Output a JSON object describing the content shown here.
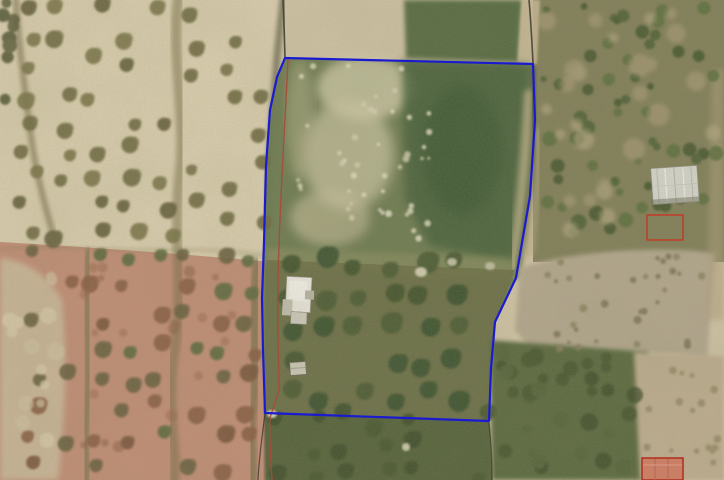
{
  "meta": {
    "kind": "aerial-orthophoto-with-cadastral-overlay",
    "width": 724,
    "height": 480
  },
  "overlay_colors": {
    "parcel_blue": "#1a1ad0",
    "cadastral_red": "#a84a38",
    "marker_red": "#c23b28",
    "roof_red": "#b23322"
  },
  "scene": {
    "layers": [
      {
        "type": "rect",
        "name": "base-ground",
        "x": 0,
        "y": 0,
        "w": 724,
        "h": 480,
        "fill": "#d2c4a6"
      },
      {
        "type": "path",
        "name": "field-left-top",
        "d": "M0,0 H283 V263 Q140,250 0,242 Z",
        "fill": "#dbcfaf"
      },
      {
        "type": "path",
        "name": "field-left-bottom",
        "d": "M0,242 Q140,250 283,263 V480 H0 Z",
        "fill": "#c28e76"
      },
      {
        "type": "path",
        "name": "field-left-far-pale",
        "d": "M0,258 Q40,262 62,300 Q70,380 58,480 H0 Z",
        "fill": "#cdbd9e",
        "opacity": 0.85,
        "blur": 3
      },
      {
        "type": "path",
        "name": "field-boundary-mid-horizontal",
        "d": "M0,248 C60,244 120,252 180,250 C230,249 262,255 283,259",
        "stroke": "#8a7a55",
        "width": 3,
        "opacity": 0.35,
        "blur": 2
      },
      {
        "type": "path",
        "name": "track-top-far-left",
        "d": "M16,0 C18,40 24,80 30,130 C34,160 40,190 52,230",
        "stroke": "#6a603b",
        "width": 6,
        "opacity": 0.55,
        "blur": 2
      },
      {
        "type": "path",
        "name": "track-mid-left-field",
        "d": "M178,0 C171,60 187,120 179,180 C173,240 185,300 173,360 C167,420 178,450 174,480",
        "stroke": "#756b42",
        "width": 10,
        "opacity": 0.5,
        "blur": 2
      },
      {
        "type": "path",
        "name": "track-left-lower",
        "d": "M89,252 C84,300 92,360 86,420 C84,450 87,465 86,480",
        "stroke": "#5e693c",
        "width": 8,
        "opacity": 0.5,
        "blur": 2
      },
      {
        "type": "path",
        "name": "track-right-lower",
        "d": "M257,262 C252,310 258,370 252,420 C250,450 254,465 252,480",
        "stroke": "#566139",
        "width": 9,
        "opacity": 0.5,
        "blur": 2
      },
      {
        "type": "rect",
        "name": "scrub-right-base",
        "x": 533,
        "y": 0,
        "w": 191,
        "h": 262,
        "fill": "#83805a"
      },
      {
        "type": "path",
        "name": "dark-green-patch-top",
        "d": "M404,0 L522,0 L518,62 L406,58 Z",
        "fill": "#4c6339",
        "opacity": 0.9,
        "blur": 2
      },
      {
        "type": "path",
        "name": "tan-strip-top-right",
        "d": "M522,0 L540,0 L537,64 L518,62 Z",
        "fill": "#c6b794",
        "opacity": 0.9,
        "blur": 1
      },
      {
        "type": "path",
        "name": "hedge-parcel-left",
        "d": "M283,0 C280,28 278,46 277,58 C272,120 267,200 266,260 C265,330 267,380 266,413 C266,440 267,460 267,480",
        "stroke": "#4e4c34",
        "width": 7,
        "opacity": 0.6,
        "blur": 2
      },
      {
        "type": "polygon",
        "name": "parcel-fill",
        "points": "285,58 533,64 535,120 530,196 516,278 495,322 491,368 489,421 265,413 263,350 262,298 264,242 266,166 270,110 277,77",
        "fill": "#6b7a4f",
        "opacity": 0.97
      },
      {
        "type": "ellipse",
        "name": "parcel-light-patch-a",
        "cx": 365,
        "cy": 88,
        "rx": 48,
        "ry": 32,
        "fill": "#d8d0ae",
        "opacity": 0.75,
        "blur": 5
      },
      {
        "type": "ellipse",
        "name": "parcel-light-patch-b",
        "cx": 348,
        "cy": 155,
        "rx": 46,
        "ry": 55,
        "fill": "#d3cba8",
        "opacity": 0.7,
        "blur": 6
      },
      {
        "type": "ellipse",
        "name": "parcel-light-patch-c",
        "cx": 330,
        "cy": 218,
        "rx": 40,
        "ry": 28,
        "fill": "#c9c09c",
        "opacity": 0.6,
        "blur": 5
      },
      {
        "type": "ellipse",
        "name": "parcel-light-patch-d",
        "cx": 300,
        "cy": 120,
        "rx": 14,
        "ry": 60,
        "fill": "#b8b48c",
        "opacity": 0.5,
        "blur": 5
      },
      {
        "type": "path",
        "name": "parcel-topright-dark-green",
        "d": "M402,60 L530,64 L524,190 L515,262 L430,246 L405,200 Z",
        "fill": "#46603a",
        "opacity": 0.8,
        "blur": 4
      },
      {
        "type": "ellipse",
        "name": "parcel-dark-blob",
        "cx": 462,
        "cy": 150,
        "rx": 40,
        "ry": 65,
        "fill": "#3b5430",
        "opacity": 0.55,
        "blur": 6
      },
      {
        "type": "path",
        "name": "parcel-right-tan-inside",
        "d": "M530,95 C527,150 522,205 514,265",
        "stroke": "#c8ba92",
        "width": 12,
        "opacity": 0.7,
        "blur": 3
      },
      {
        "type": "path",
        "name": "tan-streak-right-of-parcel",
        "d": "M538,135 C535,175 531,215 527,250",
        "stroke": "#b9aa84",
        "width": 16,
        "opacity": 0.5,
        "blur": 3
      },
      {
        "type": "path",
        "name": "parcel-mid-light-band",
        "d": "M266,248 L516,258 L513,278 L265,264 Z",
        "fill": "#9a9868",
        "opacity": 0.45,
        "blur": 3
      },
      {
        "type": "path",
        "name": "parcel-grove-ground",
        "d": "M266,260 L515,270 L495,322 L489,422 L265,413 Z",
        "fill": "#6d7046",
        "opacity": 0.85
      },
      {
        "type": "path",
        "name": "strip-below-parcel",
        "d": "M265,413 L489,422 L492,480 L266,480 Z",
        "fill": "#57643c"
      },
      {
        "type": "path",
        "name": "hedge-parcel-right",
        "d": "M534,70 C536,120 531,200 517,276",
        "stroke": "#43502f",
        "width": 7,
        "opacity": 0.5,
        "blur": 2
      },
      {
        "type": "path",
        "name": "dirt-field-right",
        "d": "M520,268 C580,248 685,246 715,254 L707,358 C650,350 575,352 543,364 L515,330 Z",
        "fill": "#b4a88e",
        "blur": 2
      },
      {
        "type": "path",
        "name": "scrub-right-bottom-green",
        "d": "M490,340 L648,352 L645,480 L492,480 Z",
        "fill": "#5c6a40",
        "blur": 2
      },
      {
        "type": "path",
        "name": "tan-right-bottom",
        "d": "M634,352 L724,356 L724,480 L640,480 Z",
        "fill": "#bfae90",
        "blur": 2
      },
      {
        "type": "path",
        "name": "tan-right-edge-strip",
        "d": "M712,70 L724,70 L724,320 L706,320 Z",
        "fill": "#b0a07c",
        "opacity": 0.5,
        "blur": 3
      },
      {
        "type": "treegrid",
        "name": "olive-grid-left-top",
        "x0": 28,
        "y0": 6,
        "x1": 168,
        "y1": 248,
        "dx": 34,
        "dy": 29,
        "jitter": 9,
        "rmin": 6,
        "rmax": 9,
        "colors": [
          "#6f6b43",
          "#7b7449",
          "#655f3b"
        ],
        "skip": 0.18,
        "seed": 11,
        "opacity": 0.9
      },
      {
        "type": "treegrid",
        "name": "olive-grid-left-top-right",
        "x0": 196,
        "y0": 14,
        "x1": 264,
        "y1": 246,
        "dx": 33,
        "dy": 30,
        "jitter": 8,
        "rmin": 5,
        "rmax": 8,
        "colors": [
          "#6f6b43",
          "#78714a"
        ],
        "skip": 0.22,
        "seed": 12,
        "opacity": 0.9
      },
      {
        "type": "treegrid",
        "name": "olive-grid-left-bottom",
        "x0": 34,
        "y0": 258,
        "x1": 258,
        "y1": 478,
        "dx": 31,
        "dy": 30,
        "jitter": 8,
        "rmin": 6,
        "rmax": 9,
        "colors": [
          "#6b6240",
          "#7b573c",
          "#5e6b40",
          "#8a5f45"
        ],
        "skip": 0.15,
        "seed": 13,
        "opacity": 0.9
      },
      {
        "type": "treegrid",
        "name": "olive-grid-parcel",
        "x0": 292,
        "y0": 264,
        "x1": 482,
        "y1": 408,
        "dx": 33,
        "dy": 33,
        "jitter": 7,
        "rmin": 8,
        "rmax": 11,
        "colors": [
          "#45552f",
          "#4e5d34",
          "#3e5230"
        ],
        "skip": 0.12,
        "seed": 14,
        "opacity": 0.92
      },
      {
        "type": "treegrid",
        "name": "olive-grid-below-parcel",
        "x0": 276,
        "y0": 420,
        "x1": 488,
        "y1": 476,
        "dx": 35,
        "dy": 28,
        "jitter": 9,
        "rmin": 6,
        "rmax": 9,
        "colors": [
          "#42512e",
          "#4c5a33"
        ],
        "skip": 0.2,
        "seed": 15,
        "opacity": 0.9
      },
      {
        "type": "scatter",
        "name": "bushes-right-top",
        "x0": 540,
        "y0": 4,
        "x1": 720,
        "y1": 246,
        "count": 60,
        "rmin": 3,
        "rmax": 8,
        "colors": [
          "#4d6136",
          "#5d6f3e",
          "#44572f"
        ],
        "seed": 21,
        "opacity": 0.85
      },
      {
        "type": "scatter",
        "name": "tan-patches-right-top",
        "x0": 546,
        "y0": 10,
        "x1": 714,
        "y1": 240,
        "count": 26,
        "rmin": 5,
        "rmax": 12,
        "colors": [
          "#b3a27e",
          "#c0b08a"
        ],
        "seed": 22,
        "opacity": 0.55,
        "blur": 2
      },
      {
        "type": "scatter",
        "name": "scrub-dots-dirt-field",
        "x0": 546,
        "y0": 256,
        "x1": 704,
        "y1": 350,
        "count": 32,
        "rmin": 2,
        "rmax": 4,
        "colors": [
          "#8a815f",
          "#7b7254"
        ],
        "seed": 23,
        "opacity": 0.8
      },
      {
        "type": "scatter",
        "name": "dots-right-bottom-tan",
        "x0": 642,
        "y0": 360,
        "x1": 718,
        "y1": 472,
        "count": 18,
        "rmin": 2,
        "rmax": 4,
        "colors": [
          "#8d825e"
        ],
        "seed": 24,
        "opacity": 0.7
      },
      {
        "type": "scatter",
        "name": "blobs-right-bottom-green",
        "x0": 494,
        "y0": 346,
        "x1": 640,
        "y1": 476,
        "count": 34,
        "rmin": 4,
        "rmax": 9,
        "colors": [
          "#46552f",
          "#3f4e2b",
          "#55653a"
        ],
        "seed": 25,
        "opacity": 0.75,
        "blur": 1
      },
      {
        "type": "scatter",
        "name": "speckles-parcel-top",
        "x0": 295,
        "y0": 64,
        "x1": 430,
        "y1": 240,
        "count": 46,
        "rmin": 1.5,
        "rmax": 3.5,
        "colors": [
          "#e6e0c4",
          "#efe9d0",
          "#d9d2b4"
        ],
        "seed": 26,
        "opacity": 0.8
      },
      {
        "type": "scatter",
        "name": "trees-left-edge-top",
        "x0": 0,
        "y0": 0,
        "x1": 16,
        "y1": 110,
        "count": 9,
        "rmin": 5,
        "rmax": 8,
        "colors": [
          "#5a5a38",
          "#4f5232"
        ],
        "seed": 27,
        "opacity": 0.85
      },
      {
        "type": "scatter",
        "name": "pale-patches-far-left",
        "x0": 2,
        "y0": 268,
        "x1": 58,
        "y1": 460,
        "count": 14,
        "rmin": 4,
        "rmax": 9,
        "colors": [
          "#dbcfae",
          "#d2c4a2"
        ],
        "seed": 28,
        "opacity": 0.7,
        "blur": 1
      },
      {
        "type": "scatter",
        "name": "rust-tinge-left-bottom",
        "x0": 40,
        "y0": 260,
        "x1": 255,
        "y1": 470,
        "count": 20,
        "rmin": 3,
        "rmax": 6,
        "colors": [
          "#9a6a4c",
          "#8a5f45"
        ],
        "seed": 29,
        "opacity": 0.5,
        "blur": 1
      },
      {
        "type": "ellipse",
        "name": "light-patch-1",
        "cx": 421,
        "cy": 272,
        "rx": 6,
        "ry": 5,
        "fill": "#dcd6bb",
        "opacity": 0.9,
        "blur": 1
      },
      {
        "type": "ellipse",
        "name": "light-patch-2",
        "cx": 452,
        "cy": 262,
        "rx": 5,
        "ry": 4,
        "fill": "#d5cfb5",
        "opacity": 0.85,
        "blur": 1
      },
      {
        "type": "ellipse",
        "name": "light-patch-3",
        "cx": 490,
        "cy": 266,
        "rx": 5,
        "ry": 4,
        "fill": "#d0cab0",
        "opacity": 0.8,
        "blur": 1
      },
      {
        "type": "ellipse",
        "name": "light-patch-4",
        "cx": 406,
        "cy": 447,
        "rx": 4,
        "ry": 4,
        "fill": "#d8d3ba",
        "opacity": 0.9,
        "blur": 1
      },
      {
        "type": "ellipse",
        "name": "light-patch-corner",
        "cx": 272,
        "cy": 414,
        "rx": 5,
        "ry": 4,
        "fill": "#e9e3cd",
        "opacity": 0.9,
        "blur": 1
      },
      {
        "type": "group",
        "name": "farm-building-right",
        "rotate": [
          -4,
          675,
          185
        ],
        "parts": [
          {
            "t": "rect",
            "x": 652,
            "y": 167,
            "w": 46,
            "h": 36,
            "fill": "#d6d6cc",
            "stroke": "#94948a",
            "sw": 0.6
          },
          {
            "t": "line",
            "x1": 658,
            "y1": 168,
            "x2": 658,
            "y2": 202,
            "stroke": "#b9b9af",
            "sw": 1
          },
          {
            "t": "line",
            "x1": 666,
            "y1": 168,
            "x2": 666,
            "y2": 202,
            "stroke": "#efefe7",
            "sw": 1.2
          },
          {
            "t": "line",
            "x1": 675,
            "y1": 167,
            "x2": 675,
            "y2": 203,
            "stroke": "#b2b2a8",
            "sw": 1
          },
          {
            "t": "line",
            "x1": 684,
            "y1": 168,
            "x2": 684,
            "y2": 202,
            "stroke": "#efefe7",
            "sw": 1.2
          },
          {
            "t": "line",
            "x1": 692,
            "y1": 168,
            "x2": 692,
            "y2": 202,
            "stroke": "#b9b9af",
            "sw": 1
          },
          {
            "t": "line",
            "x1": 652,
            "y1": 185,
            "x2": 698,
            "y2": 185,
            "stroke": "#c6c6bc",
            "sw": 0.8
          },
          {
            "t": "rect",
            "x": 650,
            "y": 198,
            "w": 48,
            "h": 5,
            "fill": "#6f6f5e",
            "opacity": 0.5
          }
        ]
      },
      {
        "type": "group",
        "name": "house-in-parcel",
        "rotate": [
          3,
          299,
          295
        ],
        "parts": [
          {
            "t": "rect",
            "x": 286,
            "y": 277,
            "w": 25,
            "h": 35,
            "fill": "#ebe8de",
            "stroke": "#a39f92",
            "sw": 0.7
          },
          {
            "t": "rect",
            "x": 289,
            "y": 281,
            "w": 18,
            "h": 20,
            "fill": "#f4f2ea"
          },
          {
            "t": "rect",
            "x": 283,
            "y": 300,
            "w": 10,
            "h": 16,
            "fill": "#c4c0b2"
          },
          {
            "t": "rect",
            "x": 292,
            "y": 312,
            "w": 16,
            "h": 12,
            "fill": "#d0ccbe",
            "stroke": "#8f8a7a",
            "sw": 0.6
          },
          {
            "t": "rect",
            "x": 305,
            "y": 290,
            "w": 9,
            "h": 9,
            "fill": "#b9b5a6"
          }
        ]
      },
      {
        "type": "group",
        "name": "shed-in-parcel",
        "rotate": [
          -4,
          298,
          368
        ],
        "parts": [
          {
            "t": "rect",
            "x": 290,
            "y": 362,
            "w": 16,
            "h": 13,
            "fill": "#cfcaba",
            "stroke": "#6f6a57",
            "sw": 0.8
          },
          {
            "t": "line",
            "x1": 290,
            "y1": 368,
            "x2": 306,
            "y2": 368,
            "stroke": "#a7a291",
            "sw": 1
          }
        ]
      },
      {
        "type": "path",
        "name": "field-line-top-left",
        "layer": "overlay",
        "d": "M283,0 C284,20 284.5,40 285,57",
        "stroke": "#3c3c30",
        "width": 1.6,
        "opacity": 0.85
      },
      {
        "type": "path",
        "name": "field-line-top-right",
        "layer": "overlay",
        "d": "M529,0 C531,22 532,44 533,63",
        "stroke": "#3c3c30",
        "width": 1.6,
        "opacity": 0.85
      },
      {
        "type": "path",
        "name": "field-line-bottom-right",
        "layer": "overlay",
        "d": "M489,423 C491,443 492,462 492,480",
        "stroke": "#3a3a2c",
        "width": 1.4,
        "opacity": 0.8
      },
      {
        "type": "path",
        "name": "field-line-bottom-left",
        "layer": "overlay",
        "d": "M265,414 C262,436 259,458 258,480",
        "stroke": "#2e2e26",
        "width": 1.2,
        "opacity": 0.7
      },
      {
        "type": "path",
        "name": "cadastral-red-line",
        "layer": "overlay",
        "d": "M288,60 C284,140 279,220 278,280 C277,335 279,365 279,390 L270,418 C269,440 271,462 272,480",
        "stroke": "#a84a38",
        "width": 1.4,
        "opacity": 0.9
      },
      {
        "type": "polygon",
        "name": "parcel-boundary",
        "layer": "overlay",
        "interactable": true,
        "points": "285,58 533,64 535,120 530,196 516,278 495,322 491,368 489,421 265,413 263,350 262,298 264,242 266,166 270,110 277,77",
        "fill": "none",
        "stroke": "#1a1ad0",
        "width": 2.2
      },
      {
        "type": "rect",
        "name": "red-marker-rect",
        "layer": "overlay",
        "x": 647,
        "y": 215,
        "w": 36,
        "h": 25,
        "fill": "none",
        "stroke": "#c23b28",
        "width": 1.5
      },
      {
        "type": "group",
        "name": "red-roof-building",
        "layer": "overlay",
        "parts": [
          {
            "t": "rect",
            "x": 642,
            "y": 458,
            "w": 41,
            "h": 22,
            "fill": "#c97f66",
            "stroke": "#b23322",
            "sw": 1.6
          },
          {
            "t": "line",
            "x1": 655,
            "y1": 459,
            "x2": 655,
            "y2": 480,
            "stroke": "#b06a52",
            "sw": 1
          },
          {
            "t": "line",
            "x1": 668,
            "y1": 459,
            "x2": 668,
            "y2": 480,
            "stroke": "#b06a52",
            "sw": 1
          },
          {
            "t": "line",
            "x1": 643,
            "y1": 465,
            "x2": 682,
            "y2": 465,
            "stroke": "#d89a82",
            "sw": 1
          }
        ]
      }
    ]
  }
}
